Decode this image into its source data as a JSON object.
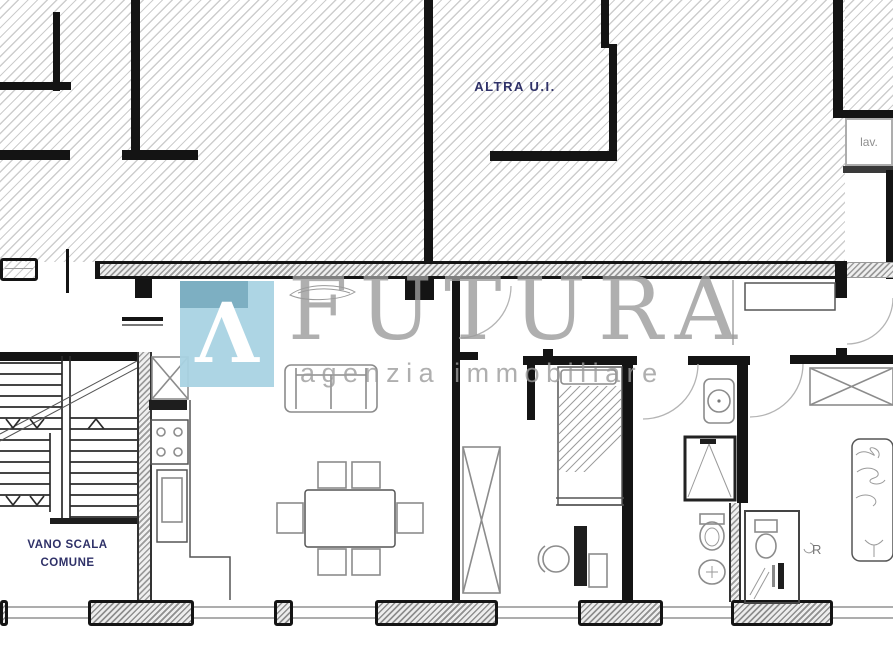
{
  "plan": {
    "labels": {
      "other_unit": "ALTRA U.I.",
      "laundry": "lav.",
      "stairwell_line1": "VANO SCALA",
      "stairwell_line2": "COMUNE",
      "radiator": "R"
    },
    "watermark": {
      "logo_glyph": "Λ",
      "brand": "FUTURA",
      "tagline": "agenzia immobiliare"
    },
    "colors": {
      "background": "#ffffff",
      "wall": "#141414",
      "hatch_line": "#cdcdcd",
      "furniture_line": "#8c8c8c",
      "label_navy": "#2f3168",
      "label_gray": "#8f8f8f",
      "logo_blue": "#a9d3e3",
      "logo_fold": "#6fa3b8",
      "watermark_gray": "#9c9c9c"
    }
  }
}
